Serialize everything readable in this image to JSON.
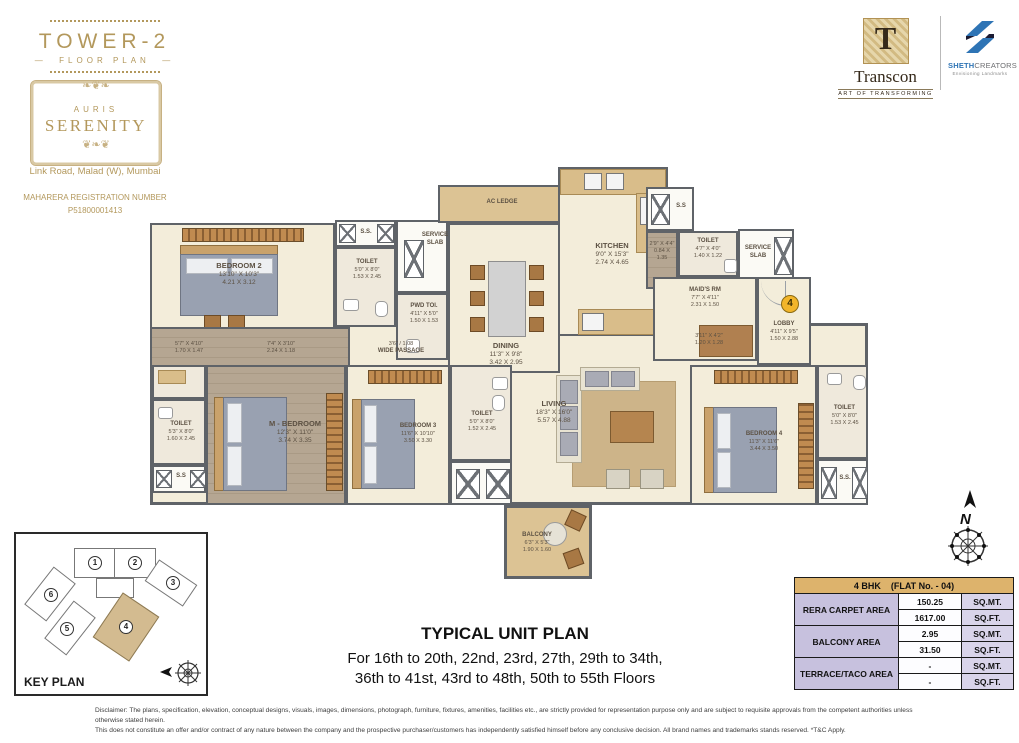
{
  "brand": {
    "tower_title": "TOWER-2",
    "tower_subtitle": "FLOOR PLAN",
    "logo_top": "AURIS",
    "logo_name": "SERENITY",
    "address": "Link Road, Malad (W), Mumbai",
    "rera_label": "MAHARERA REGISTRATION NUMBER",
    "rera_number": "P51800001413"
  },
  "developers": {
    "transcon": {
      "monogram": "T",
      "name": "Transcon",
      "tagline": "ART OF TRANSFORMING"
    },
    "sheth": {
      "name_bold": "SHETH",
      "name_light": "CREATORS",
      "tagline": "Envisioning Landmarks"
    }
  },
  "plan": {
    "flat_badge": "4",
    "compass_label": "N",
    "rooms": {
      "bedroom2": {
        "name": "BEDROOM 2",
        "ft": "13'10\" X 10'3\"",
        "m": "4.21 X 3.12"
      },
      "ss_tl": {
        "name": "S.S."
      },
      "toilet_tl": {
        "name": "TOILET",
        "ft": "5'0\" X 8'0\"",
        "m": "1.53 X 2.45"
      },
      "service_tl": {
        "name": "SERVICE SLAB"
      },
      "pwd": {
        "name": "PWD TOI.",
        "ft": "4'11\" X 5'0\"",
        "m": "1.50 X 1.53"
      },
      "ac_ledge": {
        "name": "AC LEDGE"
      },
      "dining": {
        "name": "DINING",
        "ft": "11'3\" X 9'8\"",
        "m": "3.42 X 2.95"
      },
      "kitchen": {
        "name": "KITCHEN",
        "ft": "9'0\" X 15'3\"",
        "m": "2.74 X 4.65"
      },
      "ss_tr": {
        "name": "S.S"
      },
      "duct_tr": {
        "ft": "2'9\" X 4'4\"",
        "m": "0.84 X 1.35"
      },
      "toilet_tr": {
        "name": "TOILET",
        "ft": "4'7\" X 4'0\"",
        "m": "1.40 X 1.22"
      },
      "service_tr": {
        "name": "SERVICE SLAB"
      },
      "maids": {
        "name": "MAID'S RM",
        "ft": "7'7\" X 4'11\"",
        "m": "2.31 X 1.50"
      },
      "lobby": {
        "name": "LOBBY",
        "ft": "4'11\" X 9'5\"",
        "m": "1.50 X 2.88"
      },
      "foyer": {
        "ft": "3'11\" X 4'2\"",
        "m": "1.20 X 1.28"
      },
      "passage": {
        "dim": "3'6\" / 1.08",
        "name": "WIDE PASSAGE"
      },
      "dress1": {
        "ft": "5'7\" X 4'10\"",
        "m": "1.70 X 1.47"
      },
      "dress2": {
        "ft": "7'4\" X 3'10\"",
        "m": "2.24 X 1.18"
      },
      "toilet_left": {
        "name": "TOILET",
        "ft": "5'3\" X 8'0\"",
        "m": "1.60 X 2.45"
      },
      "ss_bl": {
        "name": "S.S"
      },
      "m_bedroom": {
        "name": "M - BEDROOM",
        "ft": "12'3\" X 11'0\"",
        "m": "3.74 X 3.35"
      },
      "bedroom3": {
        "name": "BEDROOM 3",
        "ft": "11'6\" X 10'10\"",
        "m": "3.50 X 3.30"
      },
      "toilet_mid": {
        "name": "TOILET",
        "ft": "5'0\" X 8'0\"",
        "m": "1.52 X 2.45"
      },
      "living": {
        "name": "LIVING",
        "ft": "18'3\" X 16'0\"",
        "m": "5.57 X 4.88"
      },
      "bedroom4": {
        "name": "BEDROOM 4",
        "ft": "11'3\" X 11'6\"",
        "m": "3.44 X 3.50"
      },
      "toilet_right": {
        "name": "TOILET",
        "ft": "5'0\" X 8'0\"",
        "m": "1.53 X 2.45"
      },
      "ss_br": {
        "name": "S.S."
      },
      "balcony": {
        "name": "BALCONY",
        "ft": "6'3\" X 5'3\"",
        "m": "1.90 X 1.60"
      }
    }
  },
  "key_plan": {
    "title": "KEY PLAN",
    "unit_numbers": [
      "1",
      "2",
      "3",
      "4",
      "5",
      "6"
    ],
    "highlighted_unit": "4"
  },
  "area_table": {
    "header_left": "4 BHK",
    "header_right": "(FLAT No. - 04)",
    "rows": [
      {
        "label": "RERA CARPET AREA",
        "mt": "150.25",
        "mt_unit": "SQ.MT.",
        "ft": "1617.00",
        "ft_unit": "SQ.FT."
      },
      {
        "label": "BALCONY AREA",
        "mt": "2.95",
        "mt_unit": "SQ.MT.",
        "ft": "31.50",
        "ft_unit": "SQ.FT."
      },
      {
        "label": "TERRACE/TACO AREA",
        "mt": "-",
        "mt_unit": "SQ.MT.",
        "ft": "-",
        "ft_unit": "SQ.FT."
      }
    ]
  },
  "footer": {
    "title": "TYPICAL UNIT PLAN",
    "line1": "For 16th to 20th, 22nd, 23rd, 27th, 29th to 34th,",
    "line2": "36th to 41st, 43rd to 48th, 50th to 55th Floors"
  },
  "disclaimer": {
    "line1": "Disclaimer: The plans, specification, elevation, conceptual designs, visuals, images, dimensions, photograph, furniture, fixtures, amenities, facilities etc., are strictly provided for representation purpose only and are subject to requisite approvals from the competent authorities unless otherwise stated herein.",
    "line2": "This does not constitute an offer and/or contract of any nature between the company and the prospective purchaser/customers has independently satisfied himself before any conclusive decision. All brand names and trademarks stands reserved. *T&C Apply."
  },
  "colors": {
    "gold": "#b3985c",
    "wall": "#5f6368",
    "floor": "#f3edda",
    "tan": "#dcc394",
    "table_header": "#ddb36c",
    "table_label": "#c7c1de",
    "sheth_blue": "#2e74b5",
    "badge_yellow": "#f2b52a"
  }
}
